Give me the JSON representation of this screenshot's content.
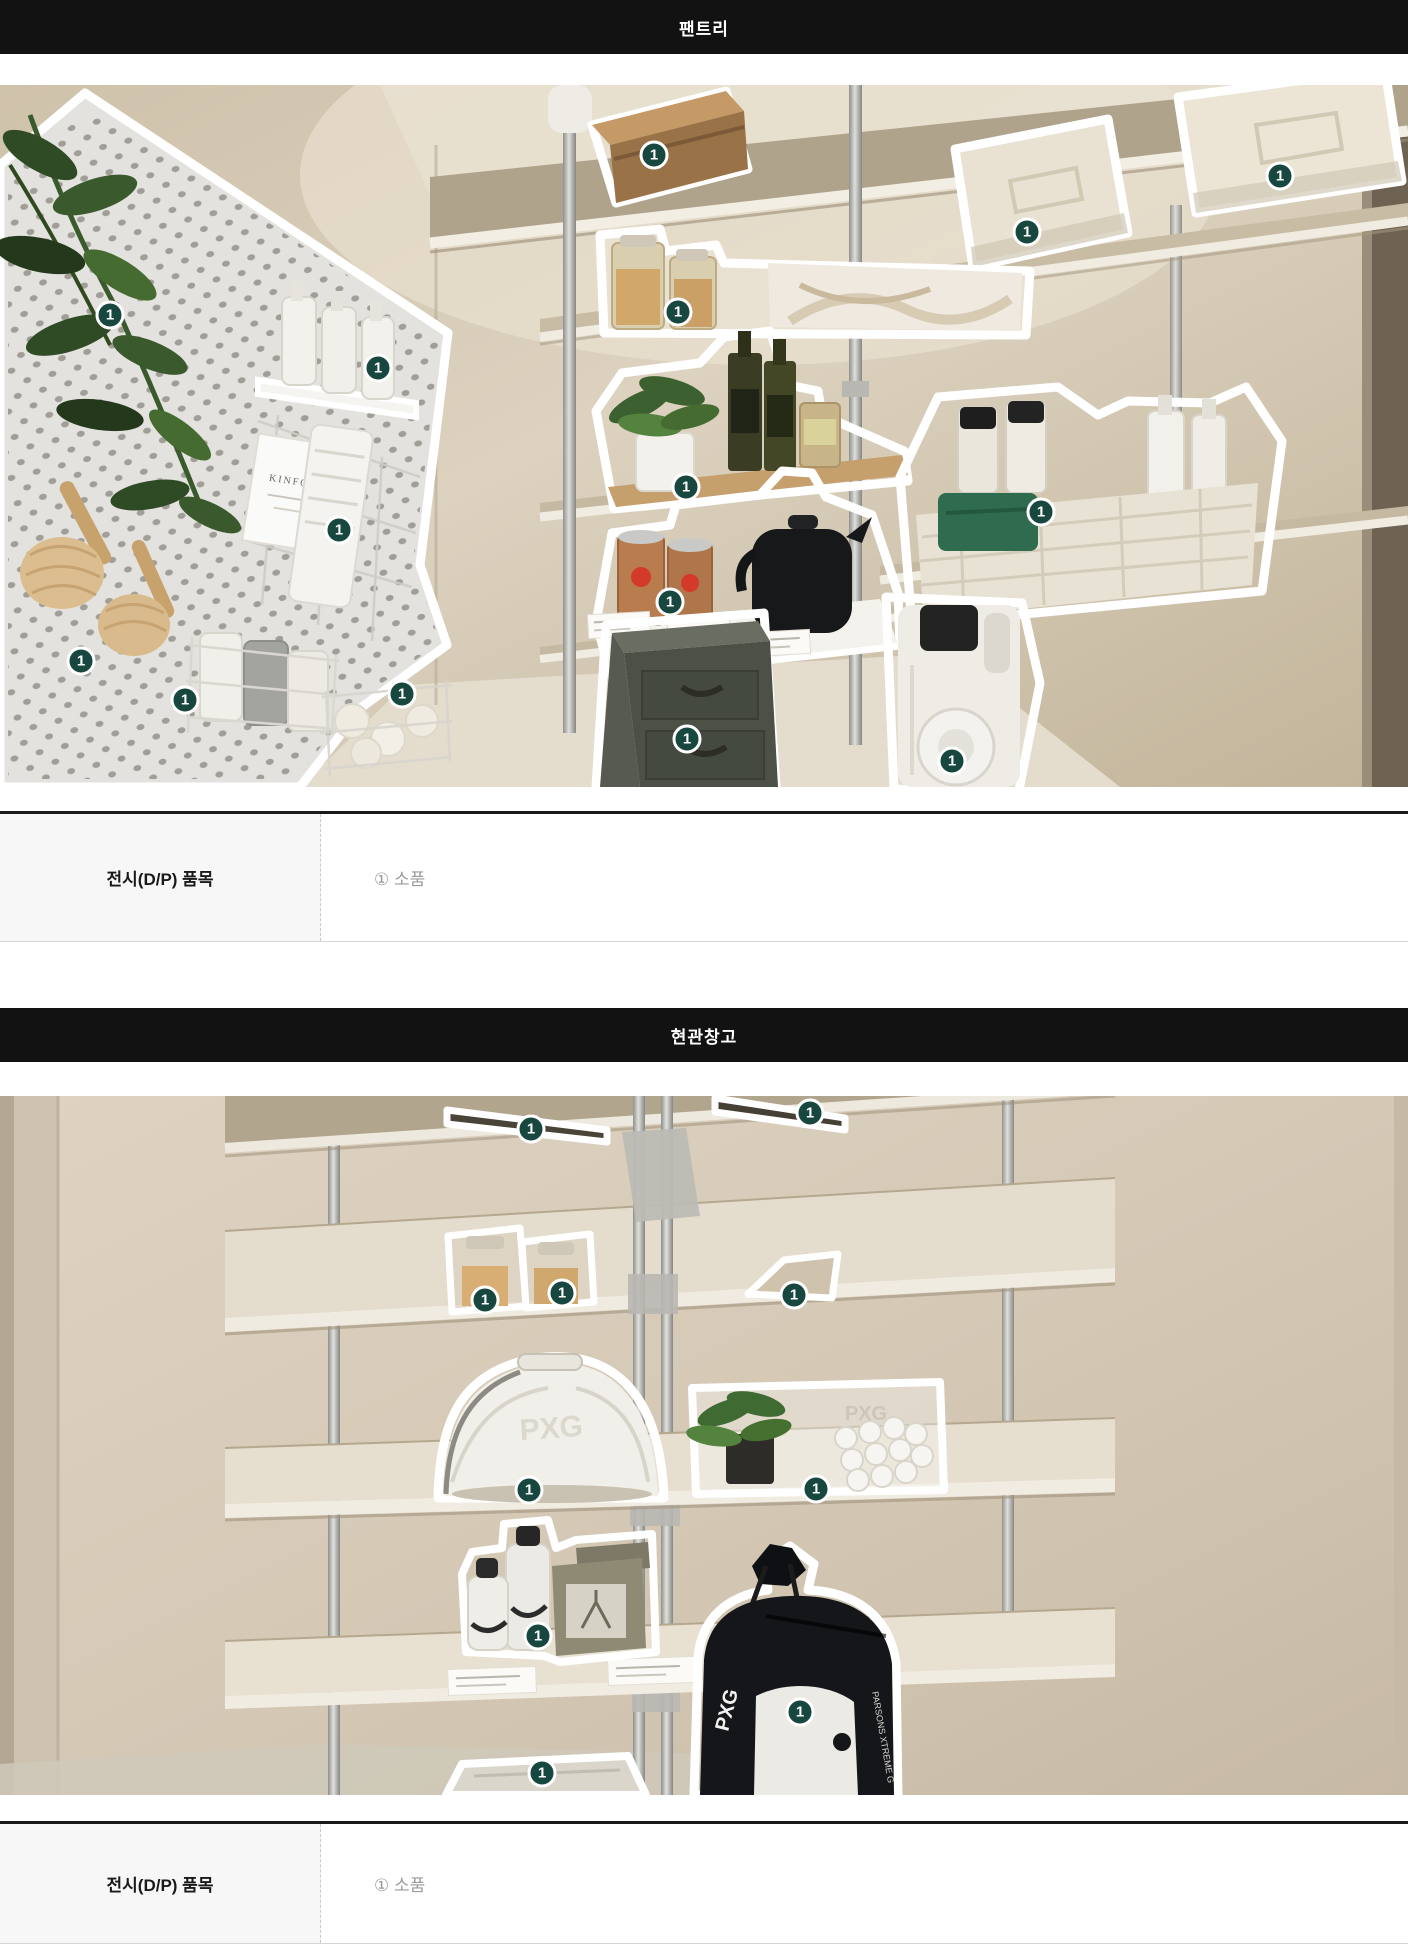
{
  "page_background": "#ffffff",
  "theme": {
    "section_header_bg": "#121212",
    "section_header_text": "#ffffff",
    "badge_bg": "#17473f",
    "badge_ring": "#ffffff",
    "table_header_bg": "#f7f7f7",
    "table_border_top": "#1a1a1a",
    "table_value_text": "#9a9a9a"
  },
  "sections": [
    {
      "header": {
        "title": "팬트리"
      },
      "photo": {
        "description": "pantry-shelves-annotated-photo",
        "badges": [
          {
            "x": 110,
            "y": 230,
            "label": "1"
          },
          {
            "x": 378,
            "y": 283,
            "label": "1"
          },
          {
            "x": 654,
            "y": 70,
            "label": "1"
          },
          {
            "x": 678,
            "y": 227,
            "label": "1"
          },
          {
            "x": 1027,
            "y": 147,
            "label": "1"
          },
          {
            "x": 1280,
            "y": 91,
            "label": "1"
          },
          {
            "x": 339,
            "y": 445,
            "label": "1"
          },
          {
            "x": 686,
            "y": 402,
            "label": "1"
          },
          {
            "x": 1041,
            "y": 427,
            "label": "1"
          },
          {
            "x": 670,
            "y": 517,
            "label": "1"
          },
          {
            "x": 81,
            "y": 576,
            "label": "1"
          },
          {
            "x": 185,
            "y": 615,
            "label": "1"
          },
          {
            "x": 402,
            "y": 609,
            "label": "1"
          },
          {
            "x": 687,
            "y": 654,
            "label": "1"
          },
          {
            "x": 952,
            "y": 676,
            "label": "1"
          }
        ]
      },
      "table": {
        "row_label": "전시(D/P) 품목",
        "row_value": "① 소품"
      }
    },
    {
      "header": {
        "title": "현관창고"
      },
      "photo": {
        "description": "entryway-storage-shelves-annotated-photo",
        "badges": [
          {
            "x": 531,
            "y": 33,
            "label": "1"
          },
          {
            "x": 810,
            "y": 17,
            "label": "1"
          },
          {
            "x": 485,
            "y": 204,
            "label": "1"
          },
          {
            "x": 562,
            "y": 197,
            "label": "1"
          },
          {
            "x": 794,
            "y": 199,
            "label": "1"
          },
          {
            "x": 529,
            "y": 394,
            "label": "1"
          },
          {
            "x": 816,
            "y": 393,
            "label": "1"
          },
          {
            "x": 538,
            "y": 540,
            "label": "1"
          },
          {
            "x": 800,
            "y": 616,
            "label": "1"
          },
          {
            "x": 542,
            "y": 677,
            "label": "1"
          }
        ]
      },
      "table": {
        "row_label": "전시(D/P) 품목",
        "row_value": "① 소품"
      }
    }
  ]
}
